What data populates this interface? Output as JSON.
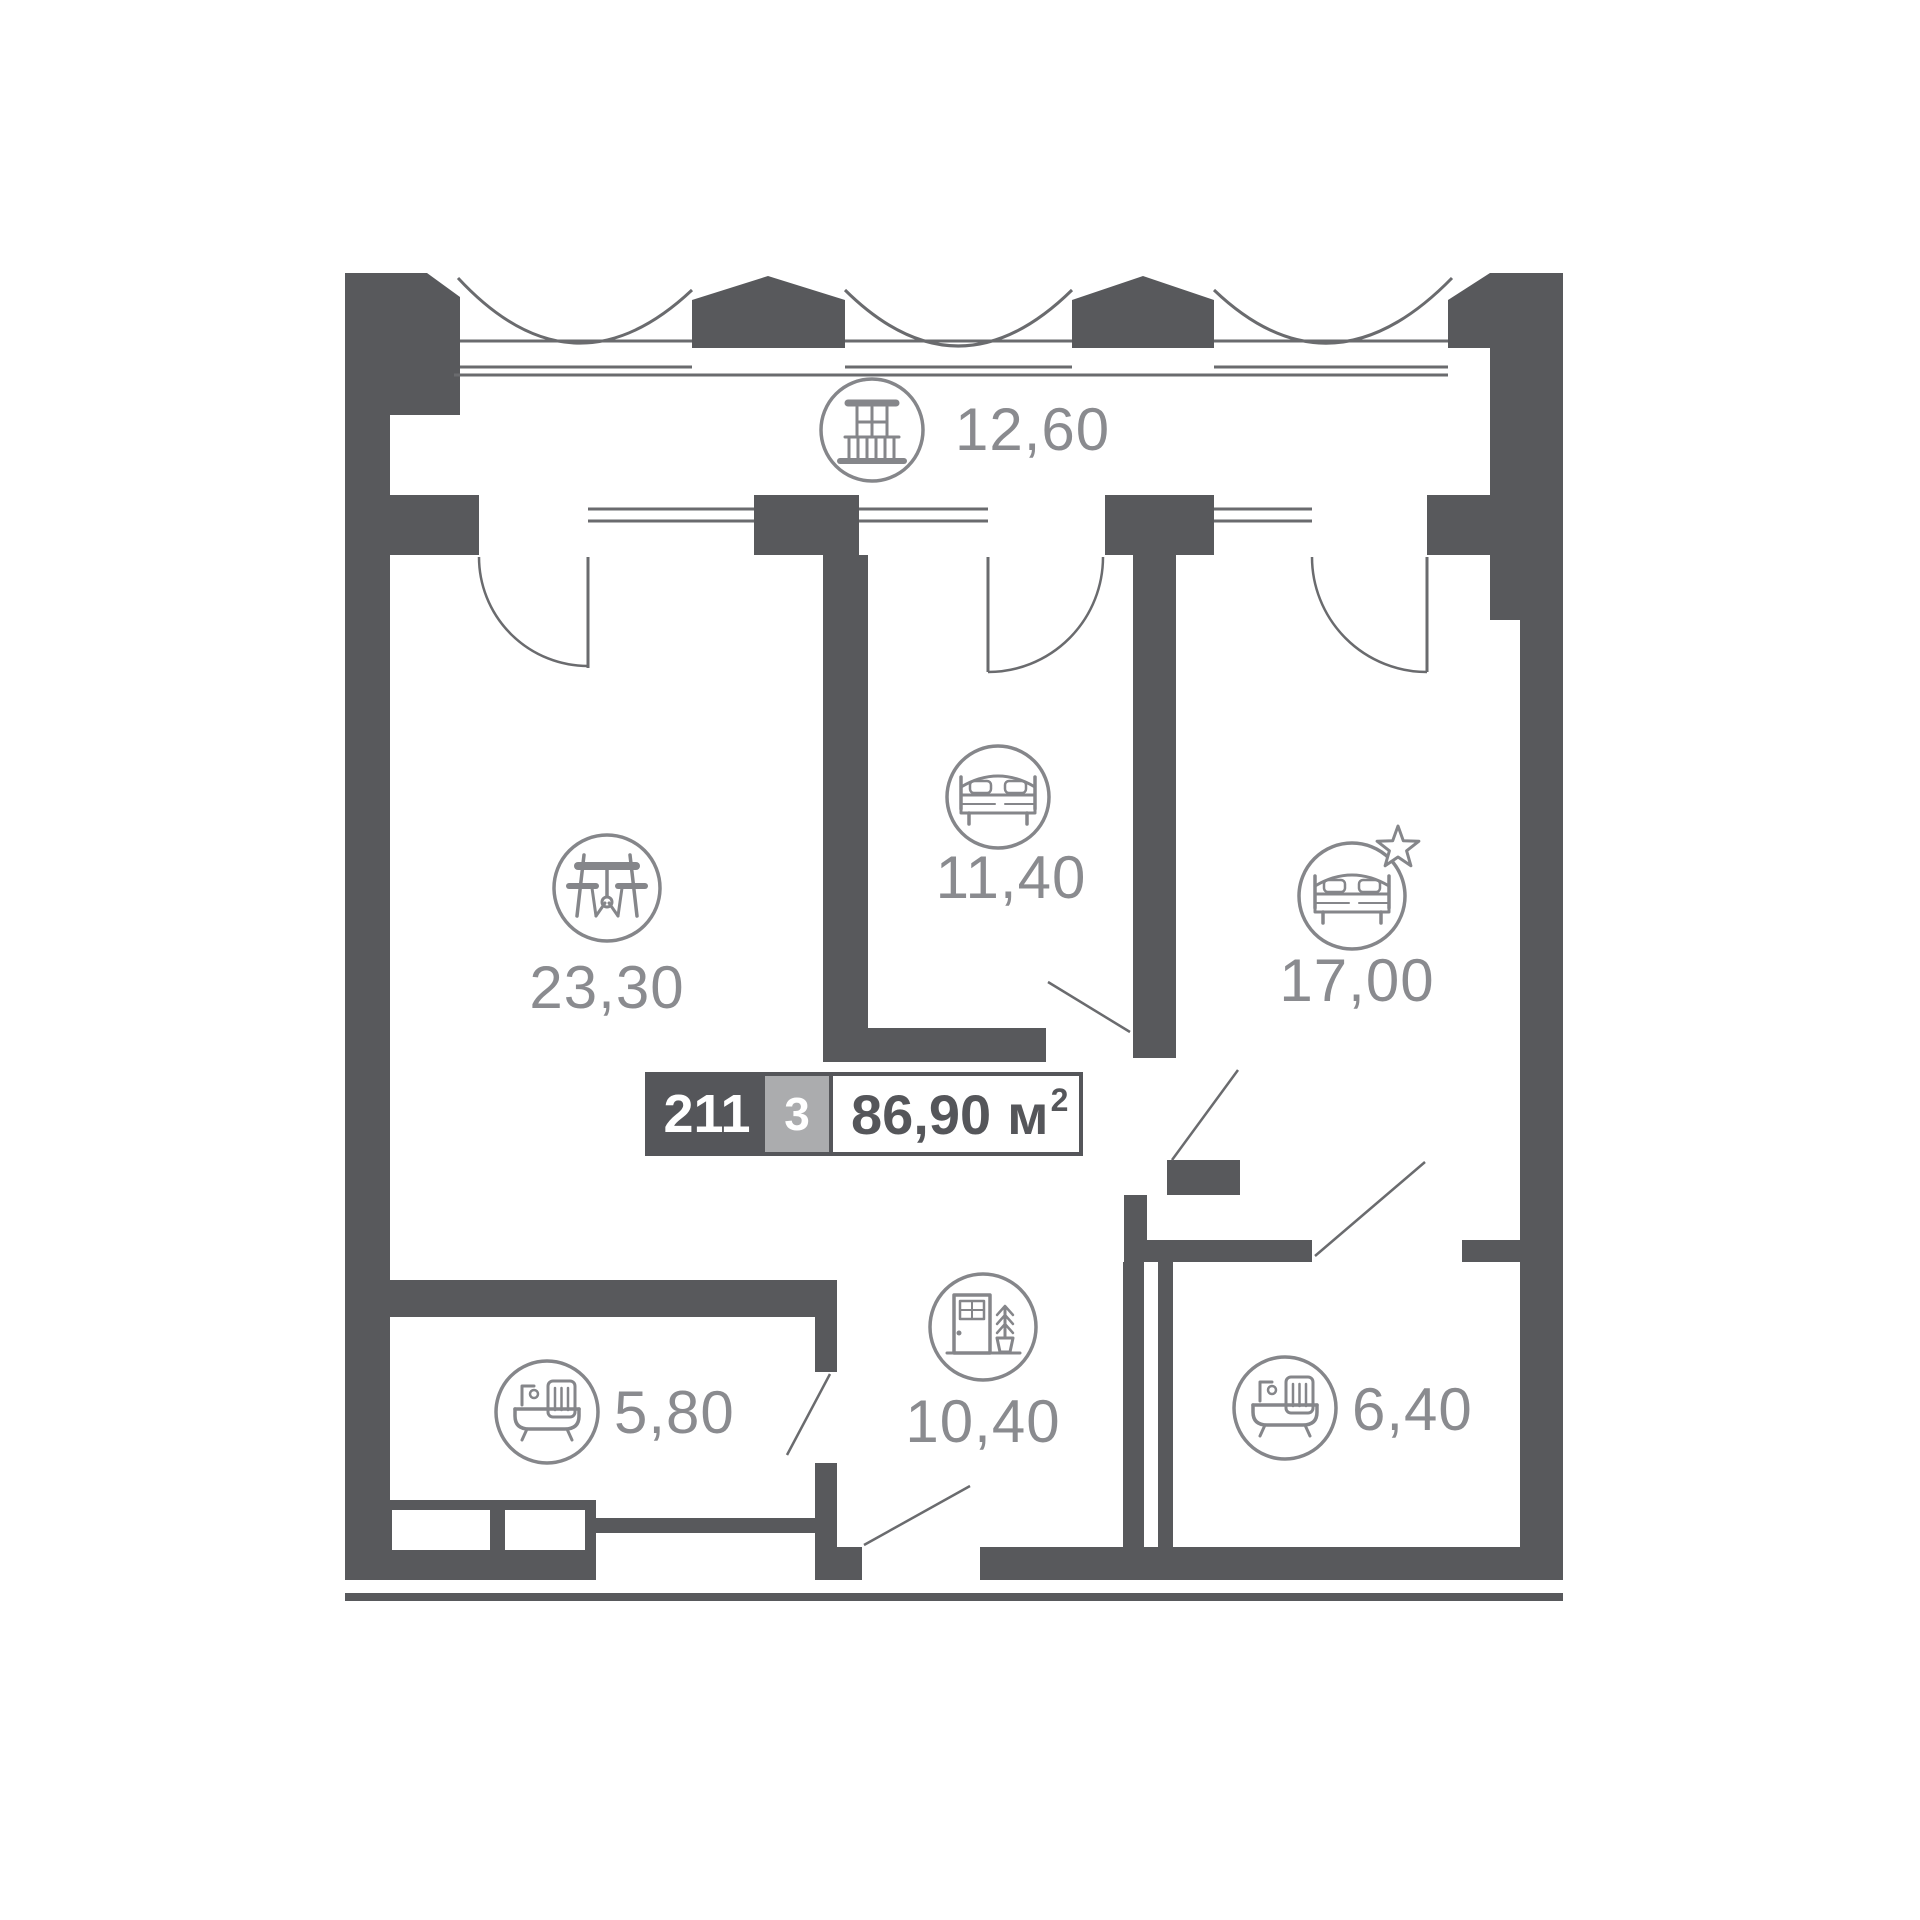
{
  "plan": {
    "title": "apartment-floor-plan",
    "unit": {
      "number": "211",
      "rooms_count": "3",
      "area_value": "86,90",
      "area_unit": "м",
      "area_sup": "2"
    },
    "rooms": [
      {
        "id": "balcony",
        "label": "12,60",
        "icon": "balcony-icon"
      },
      {
        "id": "living-room",
        "label": "23,30",
        "icon": "dining-table-icon"
      },
      {
        "id": "bedroom",
        "label": "11,40",
        "icon": "bed-icon"
      },
      {
        "id": "master-bedroom",
        "label": "17,00",
        "icon": "bed-star-icon"
      },
      {
        "id": "bathroom-1",
        "label": "5,80",
        "icon": "bathtub-icon"
      },
      {
        "id": "hallway",
        "label": "10,40",
        "icon": "door-plant-icon"
      },
      {
        "id": "bathroom-2",
        "label": "6,40",
        "icon": "bathtub-icon"
      }
    ],
    "colors": {
      "background": "#FFFFFF",
      "wall": "#58595C",
      "line": "#6A6B6E",
      "icon": "#85868A",
      "label": "#8A8B8F",
      "badge_number_bg": "#55565A",
      "badge_rooms_bg": "#ABACAE",
      "badge_text": "#55565A"
    }
  }
}
